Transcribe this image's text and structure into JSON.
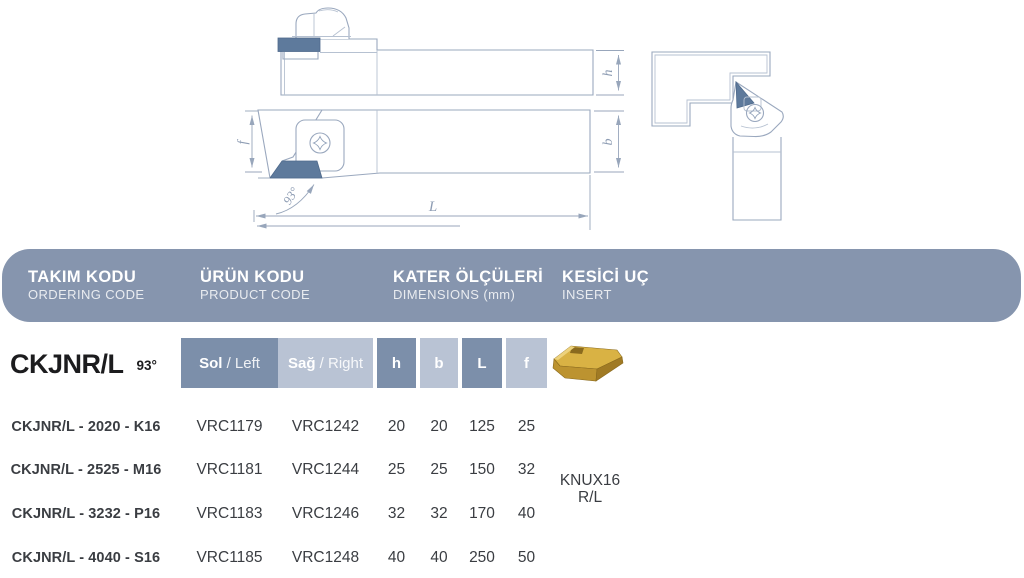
{
  "header": {
    "columns": [
      {
        "tr": "TAKIM KODU",
        "en": "ORDERING CODE"
      },
      {
        "tr": "ÜRÜN KODU",
        "en": "PRODUCT CODE"
      },
      {
        "tr": "KATER ÖLÇÜLERİ",
        "en": "DIMENSIONS (mm)"
      },
      {
        "tr": "KESİCİ UÇ",
        "en": "INSERT"
      }
    ]
  },
  "series": {
    "code": "CKJNR/L",
    "angle": "93°"
  },
  "drawings": {
    "dim_labels": {
      "h": "h",
      "b": "b",
      "f": "f",
      "L": "L"
    },
    "angle_label": "93°"
  },
  "table": {
    "subheader": {
      "left_bold": "Sol",
      "left_rest": " / Left",
      "right_bold": "Sağ",
      "right_rest": " / Right",
      "dims": [
        "h",
        "b",
        "L",
        "f"
      ]
    },
    "rows": [
      {
        "code": "CKJNR/L - 2020 - K16",
        "left": "VRC1179",
        "right": "VRC1242",
        "h": "20",
        "b": "20",
        "L": "125",
        "f": "25"
      },
      {
        "code": "CKJNR/L - 2525 - M16",
        "left": "VRC1181",
        "right": "VRC1244",
        "h": "25",
        "b": "25",
        "L": "150",
        "f": "32"
      },
      {
        "code": "CKJNR/L - 3232 - P16",
        "left": "VRC1183",
        "right": "VRC1246",
        "h": "32",
        "b": "32",
        "L": "170",
        "f": "40"
      },
      {
        "code": "CKJNR/L - 4040 - S16",
        "left": "VRC1185",
        "right": "VRC1248",
        "h": "40",
        "b": "40",
        "L": "250",
        "f": "50"
      }
    ],
    "insert": {
      "name_line1": "KNUX16",
      "name_line2": "R/L"
    }
  },
  "colors": {
    "band": "#8695AE",
    "cell_dark": "#7C8FAA",
    "cell_light": "#B9C3D4",
    "drawing_line": "#9AA8BE",
    "insert_fill": "#5E7A9C",
    "insert_gold": "#D9B244"
  }
}
